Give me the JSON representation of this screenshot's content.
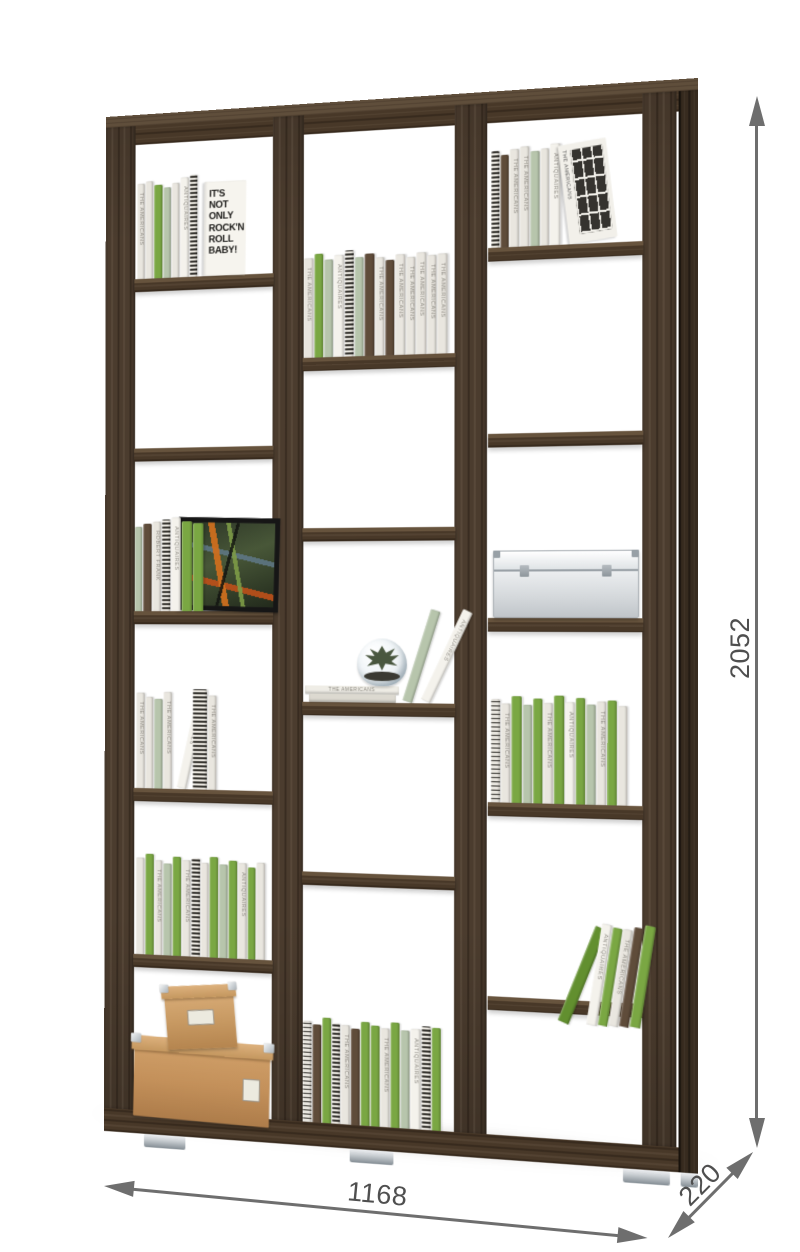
{
  "dimensions": {
    "height": "2052",
    "width": "1168",
    "depth": "220"
  },
  "colors": {
    "dim_line": "#6e6e6e",
    "dim_text": "#4f4f4f",
    "wood_base": "#4b3c2e",
    "wood_side": "#372b1f",
    "wood_top": "#5f4e3b",
    "book_white": "#e9e6df",
    "book_bright_white": "#f4f2ec",
    "book_sage": "#b7c5ac",
    "book_green": "#7aa743",
    "book_dark_green": "#628f2f",
    "book_brown": "#5f4c3a",
    "carton": "#c3905a",
    "metal_box": "#dfe3e6",
    "foot_chrome": "#c9ced2"
  },
  "titles": [
    "THE AMERICANS",
    "ANTIQUAIRES",
    "ROBERT FRANK"
  ],
  "front_book": {
    "lines": [
      "IT'S NOT",
      "ONLY",
      "ROCK'N",
      "ROLL",
      "BABY!"
    ]
  },
  "photo_book": {
    "title": "THE AMERICANS"
  },
  "stack_book_title": "THE AMERICANS",
  "shelf_unit": {
    "stile_w": 32,
    "stiles": [
      0,
      177,
      361,
      542
    ],
    "side_face": {
      "x": 576,
      "w": 18
    },
    "top_surface_h": 11,
    "top_rail": [
      11,
      19
    ],
    "bottom_rail": [
      991,
      23
    ],
    "feet_x": [
      43,
      257,
      524,
      578
    ],
    "columns": [
      {
        "x": 32,
        "w": 145,
        "shelves": [
          164,
          333,
          495,
          671,
          836
        ]
      },
      {
        "x": 209,
        "w": 152,
        "shelves": [
          248,
          414,
          583,
          748
        ]
      },
      {
        "x": 395,
        "w": 147,
        "shelves": [
          149,
          326,
          501,
          676,
          860
        ]
      }
    ],
    "items": [
      {
        "col": 0,
        "on": 164,
        "type": "books",
        "x": 2,
        "books": [
          [
            "w",
            8,
            95,
            0
          ],
          [
            "w",
            8,
            97,
            null
          ],
          [
            "g",
            9,
            93,
            null
          ],
          [
            "s",
            8,
            90,
            null
          ],
          [
            "w",
            8,
            94,
            null
          ],
          [
            "W",
            9,
            99,
            1
          ],
          [
            "p",
            8,
            101,
            null
          ]
        ],
        "front_book": {
          "w": 44,
          "h": 93
        }
      },
      {
        "col": 0,
        "on": 495,
        "type": "frame_books",
        "frame": {
          "x": 46,
          "w": 96,
          "h": 82
        },
        "books": [
          [
            "s",
            8,
            84,
            null
          ],
          [
            "b",
            9,
            87,
            null
          ],
          [
            "w",
            9,
            89,
            2
          ],
          [
            "p",
            9,
            91,
            null
          ],
          [
            "W",
            10,
            93,
            1
          ],
          [
            "g",
            11,
            89,
            null
          ],
          [
            "g",
            11,
            87,
            null
          ]
        ]
      },
      {
        "col": 0,
        "on": 671,
        "type": "books",
        "x": 2,
        "books": [
          [
            "w",
            9,
            95,
            0
          ],
          [
            "w",
            8,
            91,
            null
          ],
          [
            "s",
            9,
            89,
            null
          ],
          [
            "w",
            9,
            96,
            0
          ],
          [
            "W",
            10,
            97,
            1,
            13,
            4
          ],
          [
            "p",
            15,
            99,
            null,
            0,
            6
          ],
          [
            "w",
            9,
            93,
            0
          ]
        ]
      },
      {
        "col": 0,
        "on": 836,
        "type": "books",
        "x": 2,
        "books": [
          [
            "w",
            9,
            96,
            null
          ],
          [
            "g",
            9,
            100,
            null
          ],
          [
            "w",
            8,
            94,
            0
          ],
          [
            "s",
            9,
            91,
            null
          ],
          [
            "g",
            9,
            98,
            null
          ],
          [
            "w",
            9,
            95,
            0
          ],
          [
            "p",
            9,
            97,
            null
          ],
          [
            "w",
            8,
            93,
            null
          ],
          [
            "g",
            9,
            99,
            null
          ],
          [
            "s",
            9,
            92,
            null
          ],
          [
            "g",
            9,
            96,
            null
          ],
          [
            "w",
            9,
            94,
            1
          ],
          [
            "g",
            8,
            90,
            null
          ],
          [
            "w",
            9,
            95,
            null
          ]
        ]
      },
      {
        "col": 0,
        "on": 998,
        "type": "boxes",
        "lower": {
          "x": 0,
          "w": 143,
          "h": 80
        },
        "upper": {
          "x": 34,
          "w": 73,
          "h": 62
        }
      },
      {
        "col": 1,
        "on": 248,
        "type": "books",
        "x": 0,
        "books": [
          [
            "w",
            10,
            97,
            0
          ],
          [
            "g",
            9,
            101,
            null
          ],
          [
            "s",
            9,
            95,
            null
          ],
          [
            "W",
            10,
            99,
            1
          ],
          [
            "p",
            9,
            103,
            null
          ],
          [
            "s",
            9,
            96,
            null
          ],
          [
            "b",
            10,
            99,
            null
          ],
          [
            "w",
            9,
            95,
            0
          ],
          [
            "b",
            9,
            92,
            null
          ],
          [
            "w",
            10,
            97,
            0
          ],
          [
            "w",
            9,
            94,
            0
          ],
          [
            "w",
            10,
            98,
            0
          ],
          [
            "w",
            9,
            95,
            0
          ],
          [
            "w",
            10,
            96,
            0
          ]
        ]
      },
      {
        "col": 1,
        "on": 583,
        "type": "terrarium_group"
      },
      {
        "col": 1,
        "on": 991,
        "type": "books",
        "x": 0,
        "books": [
          [
            "p",
            9,
            98,
            null
          ],
          [
            "b",
            9,
            95,
            null
          ],
          [
            "g",
            9,
            102,
            null
          ],
          [
            "p",
            8,
            97,
            null
          ],
          [
            "w",
            9,
            96,
            0
          ],
          [
            "b",
            9,
            93,
            null
          ],
          [
            "g",
            9,
            100,
            null
          ],
          [
            "g",
            9,
            97,
            null
          ],
          [
            "w",
            9,
            95,
            0
          ],
          [
            "g",
            9,
            101,
            null
          ],
          [
            "s",
            9,
            94,
            null
          ],
          [
            "W",
            10,
            96,
            1
          ],
          [
            "p",
            9,
            99,
            null
          ],
          [
            "g",
            9,
            98,
            null
          ]
        ]
      },
      {
        "col": 2,
        "on": 149,
        "type": "books",
        "x": 2,
        "books": [
          [
            "p",
            8,
            92,
            null
          ],
          [
            "b",
            8,
            88,
            null
          ],
          [
            "w",
            9,
            93,
            0
          ],
          [
            "w",
            9,
            95,
            0
          ],
          [
            "s",
            9,
            90,
            null
          ],
          [
            "w",
            8,
            92,
            null
          ],
          [
            "W",
            10,
            96,
            1
          ]
        ],
        "photo_book": {
          "w": 46,
          "h": 94
        }
      },
      {
        "col": 2,
        "on": 501,
        "type": "metal_box",
        "box": {
          "x": 4,
          "w": 140,
          "h": 64
        }
      },
      {
        "col": 2,
        "on": 676,
        "type": "books",
        "x": 2,
        "books": [
          [
            "p",
            9,
            98,
            null
          ],
          [
            "w",
            9,
            94,
            0
          ],
          [
            "g",
            10,
            101,
            null
          ],
          [
            "s",
            9,
            93,
            null
          ],
          [
            "g",
            9,
            99,
            null
          ],
          [
            "w",
            9,
            95,
            0
          ],
          [
            "g",
            10,
            102,
            null
          ],
          [
            "W",
            9,
            96,
            1
          ],
          [
            "g",
            9,
            100,
            null
          ],
          [
            "s",
            9,
            94,
            null
          ],
          [
            "w",
            9,
            97,
            0
          ],
          [
            "g",
            9,
            98,
            null
          ],
          [
            "w",
            9,
            93,
            null
          ]
        ]
      },
      {
        "col": 2,
        "on": 883,
        "type": "books",
        "x": 66,
        "books": [
          [
            "G",
            11,
            97,
            null,
            22,
            0
          ],
          [
            "W",
            10,
            96,
            1,
            9,
            16
          ],
          [
            "g",
            9,
            93,
            null,
            9
          ],
          [
            "w",
            9,
            92,
            0,
            9
          ],
          [
            "b",
            9,
            94,
            null,
            9
          ],
          [
            "g",
            10,
            96,
            null,
            9
          ]
        ]
      }
    ]
  }
}
